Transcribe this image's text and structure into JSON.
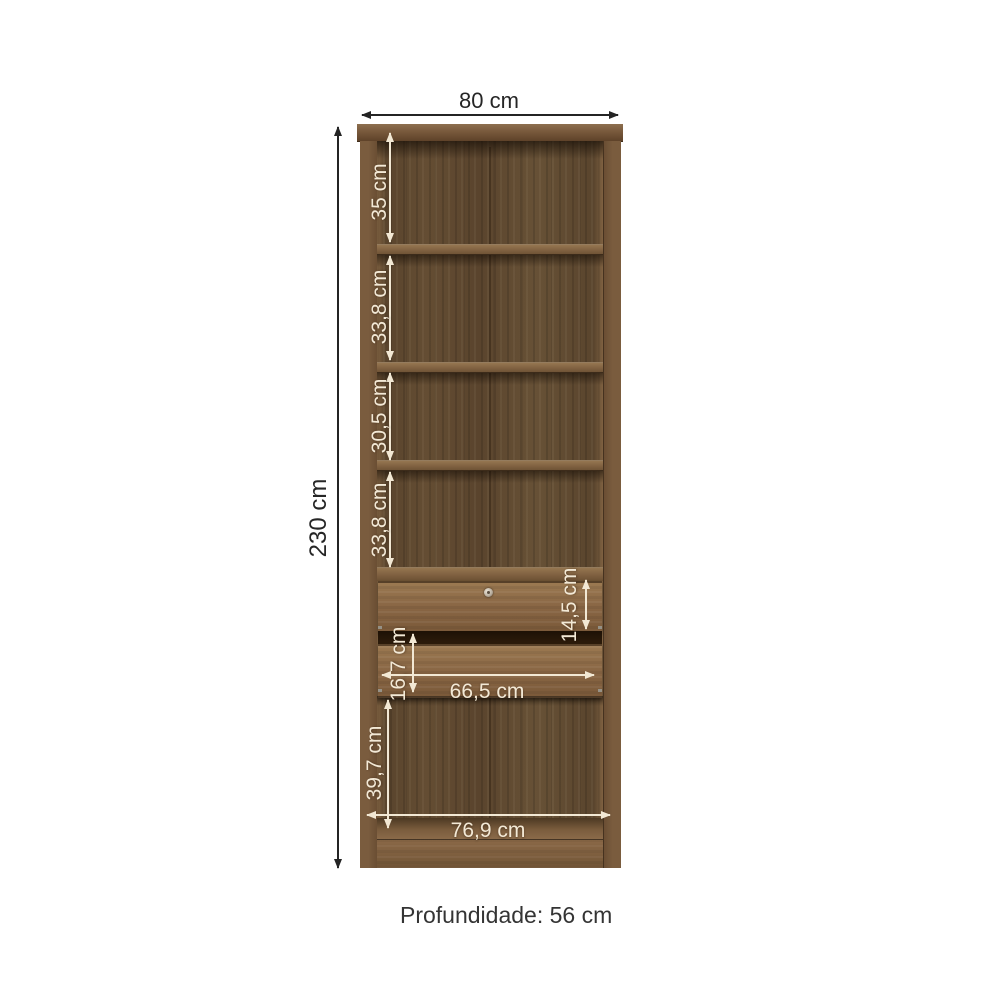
{
  "diagram": {
    "subject": "wardrobe-dimension-diagram",
    "dimensions": {
      "total_width": "80 cm",
      "total_height": "230 cm",
      "section_1": "35 cm",
      "section_2": "33,8 cm",
      "section_3": "30,5 cm",
      "section_4": "33,8 cm",
      "drawer_1_height": "14,5 cm",
      "drawer_2_height": "16,7 cm",
      "drawer_inner_width": "66,5 cm",
      "bottom_section_height": "39,7 cm",
      "bottom_inner_width": "76,9 cm"
    },
    "depth_note": "Profundidade: 56 cm",
    "colors": {
      "background": "#ffffff",
      "wood_light": "#8a6a47",
      "wood_medium": "#6f5436",
      "wood_dark": "#55402a",
      "label_on_wood": "#f2e8d4",
      "label_outside": "#262626"
    }
  }
}
